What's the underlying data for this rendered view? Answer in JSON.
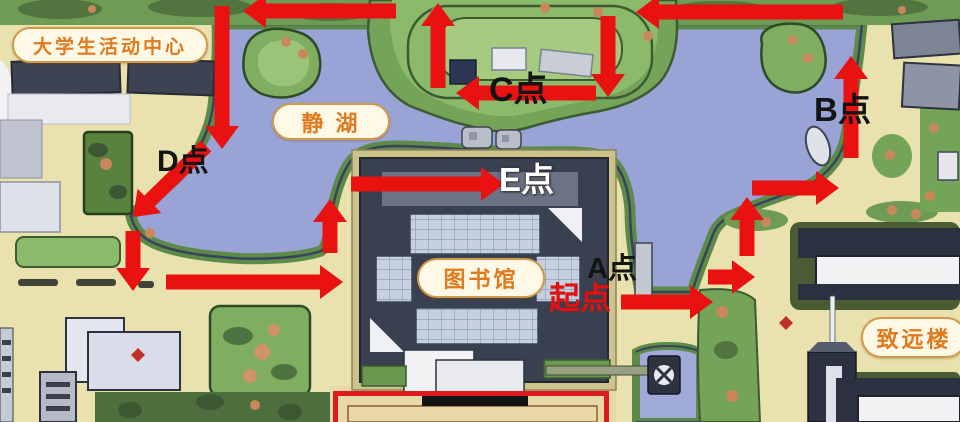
{
  "map": {
    "badges": [
      {
        "id": "activity-center",
        "label": "大学生活动中心",
        "x": 12,
        "y": 27,
        "w": 196,
        "h": 36,
        "font": 19
      },
      {
        "id": "jing-lake",
        "label": "静 湖",
        "x": 272,
        "y": 103,
        "w": 118,
        "h": 37,
        "font": 22
      },
      {
        "id": "library",
        "label": "图书馆",
        "x": 417,
        "y": 258,
        "w": 128,
        "h": 40,
        "font": 22
      },
      {
        "id": "zhiyuan-building",
        "label": "致远楼",
        "x": 861,
        "y": 317,
        "w": 106,
        "h": 41,
        "font": 22
      }
    ],
    "points": [
      {
        "id": "start",
        "label": "起点",
        "x": 549,
        "y": 283,
        "font": 31,
        "color": "#df1111",
        "style": "red"
      },
      {
        "id": "point-a",
        "label": "A点",
        "x": 587,
        "y": 255,
        "font": 29,
        "color": "#141414",
        "style": "dark"
      },
      {
        "id": "point-b",
        "label": "B点",
        "x": 814,
        "y": 93,
        "font": 33,
        "color": "#141414",
        "style": "dark"
      },
      {
        "id": "point-c",
        "label": "C点",
        "x": 489,
        "y": 73,
        "font": 34,
        "color": "#141414",
        "style": "dark"
      },
      {
        "id": "point-d",
        "label": "D点",
        "x": 157,
        "y": 147,
        "font": 30,
        "color": "#141414",
        "style": "dark"
      },
      {
        "id": "point-e",
        "label": "E点",
        "x": 499,
        "y": 163,
        "font": 33,
        "color": "#ffffff",
        "style": "light"
      }
    ],
    "route": {
      "color": "#ea1111",
      "bar_width": 15,
      "head_length": 23,
      "head_half_width": 17,
      "arrows": [
        {
          "x1": 222,
          "y1": 6,
          "x2": 222,
          "y2": 149
        },
        {
          "x1": 396,
          "y1": 11,
          "x2": 243,
          "y2": 11
        },
        {
          "x1": 438,
          "y1": 88,
          "x2": 438,
          "y2": 3
        },
        {
          "x1": 608,
          "y1": 16,
          "x2": 608,
          "y2": 97
        },
        {
          "x1": 596,
          "y1": 93,
          "x2": 456,
          "y2": 93
        },
        {
          "x1": 843,
          "y1": 12,
          "x2": 636,
          "y2": 12
        },
        {
          "x1": 851,
          "y1": 158,
          "x2": 851,
          "y2": 56
        },
        {
          "x1": 752,
          "y1": 188,
          "x2": 839,
          "y2": 188
        },
        {
          "x1": 747,
          "y1": 256,
          "x2": 747,
          "y2": 197
        },
        {
          "x1": 708,
          "y1": 277,
          "x2": 755,
          "y2": 277
        },
        {
          "x1": 621,
          "y1": 302,
          "x2": 713,
          "y2": 302
        },
        {
          "x1": 351,
          "y1": 184,
          "x2": 504,
          "y2": 184
        },
        {
          "x1": 330,
          "y1": 253,
          "x2": 330,
          "y2": 199
        },
        {
          "x1": 166,
          "y1": 282,
          "x2": 343,
          "y2": 282
        },
        {
          "x1": 133,
          "y1": 231,
          "x2": 133,
          "y2": 291
        },
        {
          "x1": 206,
          "y1": 146,
          "x2": 133,
          "y2": 217
        }
      ]
    },
    "highlight_box": {
      "x": 333,
      "y": 391,
      "w": 276,
      "h": 40,
      "border_color": "#dc1c1c",
      "border_width": 5
    }
  }
}
